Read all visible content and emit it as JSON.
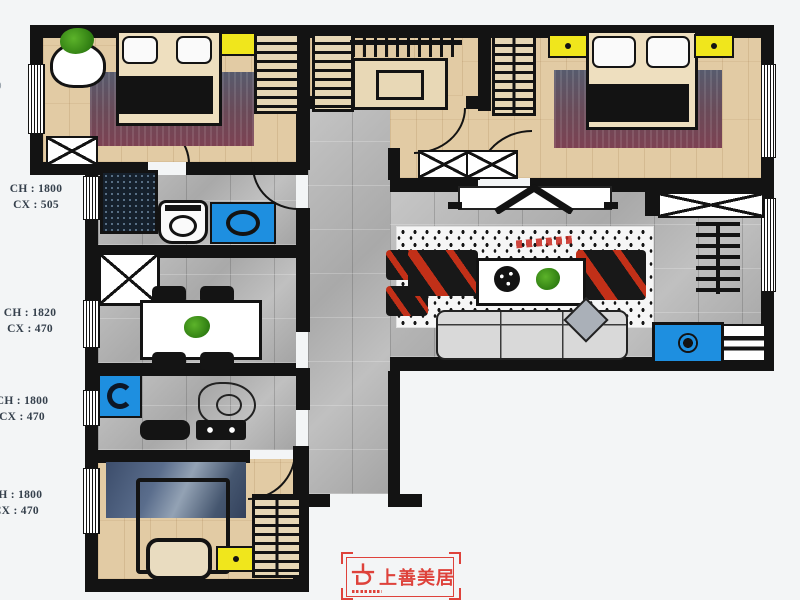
{
  "page": {
    "background": "#f3f5f6"
  },
  "dimension_labels": [
    {
      "line1": "CH : 1800",
      "line2": "CX : 505"
    },
    {
      "line1": "CH : 1820",
      "line2": "CX : 470"
    },
    {
      "line1": "CH : 1800",
      "line2": "CX : 470"
    },
    {
      "line1": "CH : 1800",
      "line2": "CX : 470"
    }
  ],
  "edge_mark": "0",
  "logo": {
    "name": "上善美居",
    "color": "#de423b"
  },
  "palette": {
    "wall": "#131313",
    "wood_floor": "#e2cba4",
    "tile_floor": "#b6b6b6",
    "rug_maroon": "#7d4253",
    "rug_slate": "#575b6d",
    "rug_navy": "#46597a",
    "highlight_yellow": "#f0e61c",
    "appliance_blue": "#1e8fe0",
    "accent_red": "#c23018",
    "plant_green": "#3f9a1d",
    "logo_red": "#de423b"
  }
}
